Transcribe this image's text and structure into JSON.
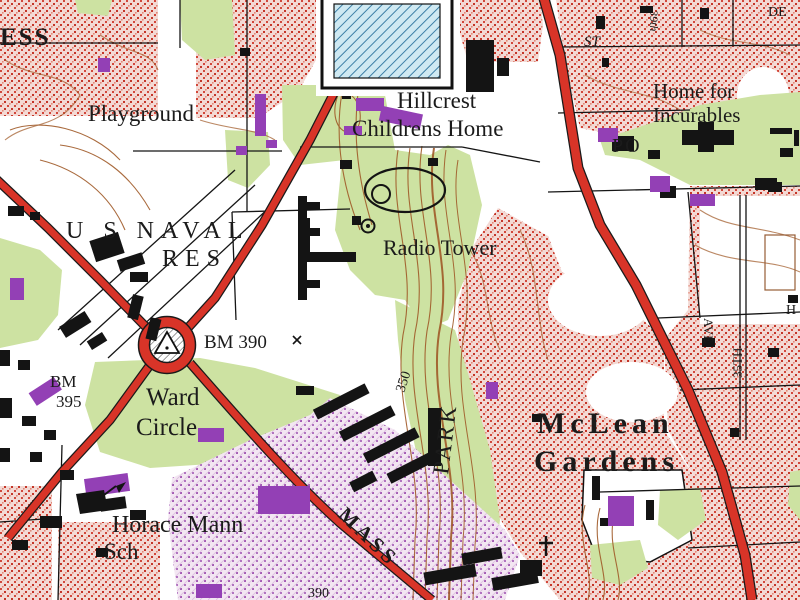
{
  "labels": {
    "ess": "ESS",
    "playground": "Playground",
    "hillcrest1": "Hillcrest",
    "hillcrest2": "Childrens Home",
    "home1": "Home for",
    "home2": "Incurables",
    "st": "ST",
    "street39": "39th",
    "de": "DE",
    "po": "PO",
    "naval1": "U S NAVAL",
    "naval2": "RES",
    "radio": "Radio Tower",
    "bm390": "BM 390",
    "ward1": "Ward",
    "ward2": "Circle",
    "bmleft1": "BM",
    "bmleft2": "395",
    "horace1": "Horace Mann",
    "horace2": "Sch",
    "mclean1": "McLean",
    "mclean2": "Gardens",
    "park": "PARK",
    "mass": "MASS",
    "contour350": "350",
    "road390": "390",
    "ave": "AVE",
    "th35": "35TH",
    "hedge": "H"
  },
  "colors": {
    "urban_tint": "#f3d9d4",
    "urban_dot": "#cf4034",
    "road_red": "#d83428",
    "woodland_green": "#cde2a2",
    "contour_brown": "#a05a28",
    "revision_purple": "#9340b5",
    "school_hatch_blue": "#cfe9f2"
  },
  "symbols": [
    {
      "name": "ward-circle-monument-icon",
      "meaning": "traffic circle with hatched monument and survey triangle"
    },
    {
      "name": "radio-tower-icon",
      "meaning": "circle with center dot marking Radio Tower"
    },
    {
      "name": "church-cross-icon",
      "meaning": "cross marking a church"
    },
    {
      "name": "school-flag-icon",
      "meaning": "building with flag marking Horace Mann Sch"
    },
    {
      "name": "running-track-icon",
      "meaning": "oval athletic track with gas-holder circle"
    },
    {
      "name": "hatched-school-building-icon",
      "meaning": "large hatched public building"
    },
    {
      "name": "benchmark-x-icon",
      "meaning": "X mark for benchmark BM 390"
    }
  ]
}
